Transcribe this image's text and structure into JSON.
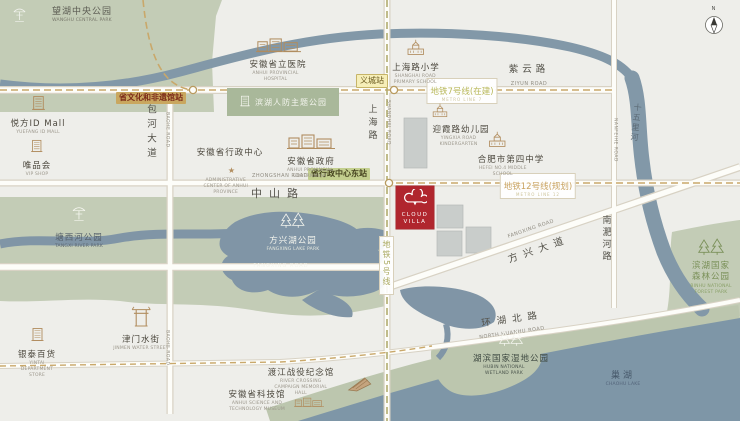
{
  "project": {
    "line1": "CLOUD",
    "line2": "VILLA"
  },
  "compass": {
    "n": "N"
  },
  "colors": {
    "accent_red": "#b0262e",
    "park_green": "#c3ccb6",
    "water_blue": "#8095a6",
    "metro_gold": "#c9a86a",
    "metro_olive": "#b2ac6e"
  },
  "metro": {
    "line5": {
      "label": "地铁5号线"
    },
    "line7": {
      "label": "地铁7号线(在建)",
      "sub": "METRO LINE 7"
    },
    "line12": {
      "label": "地铁12号线(规划)",
      "sub": "METRO LINE 12"
    }
  },
  "stations": {
    "wenhua": "省文化和非遗馆站",
    "yicheng": "义城站",
    "xingzheng_east": "省行政中心东站"
  },
  "roads": {
    "ziyun": {
      "zh": "紫云路",
      "en": "ZIYUN ROAD"
    },
    "baohe": {
      "zh": "包河大道",
      "en": "BAOHE ROAD"
    },
    "shanghai": {
      "zh": "上海路",
      "en": "SHANGHAI ROAD"
    },
    "zhongshan": {
      "zh": "中山路",
      "en": "ZHONGSHAN ROAD"
    },
    "fangxing_park": {
      "en": "FANGXING ROAD"
    },
    "fangxing_ave": {
      "zh": "方兴大道",
      "en": "FANGXING ROAD"
    },
    "nanfeihe": {
      "zh": "南淝河路",
      "en": "NANFEIHE ROAD"
    },
    "huanhu": {
      "zh": "环湖北路",
      "en": "NORTH HUANHU ROAD"
    },
    "shiwuli": {
      "zh": "十五里河"
    }
  },
  "parks": {
    "wanghu": {
      "zh": "望湖中央公园",
      "en": "WANGHU CENTRAL PARK"
    },
    "renfang": {
      "zh": "滨湖人防主题公园"
    },
    "tangxi": {
      "zh": "塘西河公园",
      "en": "TANGXI RIVER PARK"
    },
    "fangxinghu": {
      "zh": "方兴湖公园",
      "en": "FANGXING LAKE PARK"
    },
    "forest": {
      "zh": "滨湖国家森林公园",
      "en": "BINHU NATIONAL FOREST PARK"
    },
    "wetland": {
      "zh": "湖滨国家湿地公园",
      "en": "HUBIN NATIONAL WETLAND PARK"
    },
    "chaohu": {
      "zh": "巢湖",
      "en": "CHAOHU LAKE"
    }
  },
  "pois": {
    "hospital": {
      "zh": "安徽省立医院",
      "en": "ANHUI PROVINCIAL HOSPITAL"
    },
    "primary": {
      "zh": "上海路小学",
      "en": "SHANGHAI ROAD PRIMARY SCHOOL"
    },
    "idmall": {
      "zh": "悦方ID Mall",
      "en": "YUEFANG ID MALL"
    },
    "vipshop": {
      "zh": "唯品会",
      "en": "VIP SHOP"
    },
    "admin_center": {
      "zh": "安徽省行政中心",
      "en": "ADMINISTRATIVE CENTER OF ANHUI PROVINCE"
    },
    "gov": {
      "zh": "安徽省政府",
      "en": "ANHUI PROVINCIAL GOVERNMENT"
    },
    "kindergarten": {
      "zh": "迎霞路幼儿园",
      "en": "YINGXIA ROAD KINDERGARTEN"
    },
    "school4": {
      "zh": "合肥市第四中学",
      "en": "HEFEI NO.4 MIDDLE SCHOOL"
    },
    "yintai": {
      "zh": "银泰百货",
      "en": "YINTAI DEPARTMENT STORE"
    },
    "jinmen": {
      "zh": "津门水街",
      "en": "JINMEN WATER STREET"
    },
    "memorial": {
      "zh": "渡江战役纪念馆",
      "en": "RIVER CROSSING CAMPAIGN MEMORIAL HALL"
    },
    "scitech": {
      "zh": "安徽省科技馆",
      "en": "ANHUI SCIENCE AND TECHNOLOGY MUSEUM"
    }
  }
}
